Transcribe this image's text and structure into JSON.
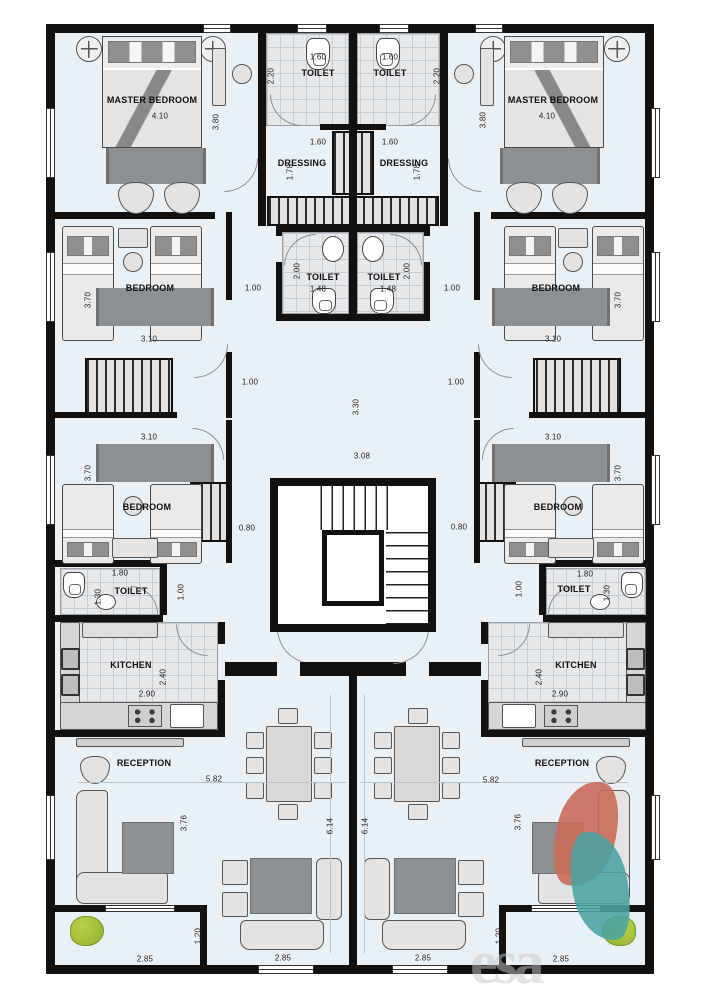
{
  "colors": {
    "floor": "#e9f1f7",
    "wall": "#111111",
    "tile": "#e6e8ea",
    "rug": "#8d9092",
    "furniture": "#e3e3e3",
    "logo_red": "#c96c59",
    "logo_teal": "#4aa3a2",
    "plant": "#9fbe3a"
  },
  "watermark": {
    "text": "esa"
  },
  "labels": [
    {
      "n": "label-master-bedroom",
      "t": "MASTER BEDROOM",
      "x": 152,
      "y": 100,
      "r": 1
    },
    {
      "n": "label-master-bedroom",
      "t": "MASTER BEDROOM",
      "x": 553,
      "y": 100,
      "r": 1
    },
    {
      "n": "label-toilet",
      "t": "TOILET",
      "x": 318,
      "y": 73,
      "r": 1
    },
    {
      "n": "label-toilet",
      "t": "TOILET",
      "x": 390,
      "y": 73,
      "r": 1
    },
    {
      "n": "label-dressing",
      "t": "DRESSING",
      "x": 302,
      "y": 163,
      "r": 1
    },
    {
      "n": "label-dressing",
      "t": "DRESSING",
      "x": 404,
      "y": 163,
      "r": 1
    },
    {
      "n": "label-toilet",
      "t": "TOILET",
      "x": 323,
      "y": 277,
      "r": 1
    },
    {
      "n": "label-toilet",
      "t": "TOILET",
      "x": 384,
      "y": 277,
      "r": 1
    },
    {
      "n": "label-bedroom",
      "t": "BEDROOM",
      "x": 150,
      "y": 288,
      "r": 1
    },
    {
      "n": "label-bedroom",
      "t": "BEDROOM",
      "x": 556,
      "y": 288,
      "r": 1
    },
    {
      "n": "label-bedroom",
      "t": "BEDROOM",
      "x": 147,
      "y": 507,
      "r": 1
    },
    {
      "n": "label-bedroom",
      "t": "BEDROOM",
      "x": 558,
      "y": 507,
      "r": 1
    },
    {
      "n": "label-toilet",
      "t": "TOILET",
      "x": 131,
      "y": 591,
      "r": 1
    },
    {
      "n": "label-toilet",
      "t": "TOILET",
      "x": 574,
      "y": 589,
      "r": 1
    },
    {
      "n": "label-kitchen",
      "t": "KITCHEN",
      "x": 131,
      "y": 665,
      "r": 1
    },
    {
      "n": "label-kitchen",
      "t": "KITCHEN",
      "x": 576,
      "y": 665,
      "r": 1
    },
    {
      "n": "label-reception",
      "t": "RECEPTION",
      "x": 144,
      "y": 763,
      "r": 1
    },
    {
      "n": "label-reception",
      "t": "RECEPTION",
      "x": 562,
      "y": 763,
      "r": 1
    },
    {
      "n": "label-dimension",
      "t": "4.10",
      "x": 160,
      "y": 116
    },
    {
      "n": "label-dimension",
      "t": "4.10",
      "x": 547,
      "y": 116
    },
    {
      "n": "label-dimension",
      "t": "3.80",
      "x": 216,
      "y": 122,
      "v": 1
    },
    {
      "n": "label-dimension",
      "t": "3.80",
      "x": 483,
      "y": 120,
      "v": 1
    },
    {
      "n": "label-dimension",
      "t": "1.60",
      "x": 318,
      "y": 57
    },
    {
      "n": "label-dimension",
      "t": "1.60",
      "x": 390,
      "y": 57
    },
    {
      "n": "label-dimension",
      "t": "2.20",
      "x": 271,
      "y": 76,
      "v": 1
    },
    {
      "n": "label-dimension",
      "t": "2.20",
      "x": 437,
      "y": 76,
      "v": 1
    },
    {
      "n": "label-dimension",
      "t": "1.60",
      "x": 318,
      "y": 142
    },
    {
      "n": "label-dimension",
      "t": "1.60",
      "x": 390,
      "y": 142
    },
    {
      "n": "label-dimension",
      "t": "1.78",
      "x": 290,
      "y": 172,
      "v": 1
    },
    {
      "n": "label-dimension",
      "t": "1.78",
      "x": 417,
      "y": 172,
      "v": 1
    },
    {
      "n": "label-dimension",
      "t": "1.48",
      "x": 318,
      "y": 289
    },
    {
      "n": "label-dimension",
      "t": "1.48",
      "x": 388,
      "y": 289
    },
    {
      "n": "label-dimension",
      "t": "2.00",
      "x": 297,
      "y": 271,
      "v": 1
    },
    {
      "n": "label-dimension",
      "t": "2.00",
      "x": 407,
      "y": 271,
      "v": 1
    },
    {
      "n": "label-dimension",
      "t": "1.00",
      "x": 253,
      "y": 288
    },
    {
      "n": "label-dimension",
      "t": "1.00",
      "x": 452,
      "y": 288
    },
    {
      "n": "label-dimension",
      "t": "3.70",
      "x": 88,
      "y": 300,
      "v": 1
    },
    {
      "n": "label-dimension",
      "t": "3.70",
      "x": 618,
      "y": 300,
      "v": 1
    },
    {
      "n": "label-dimension",
      "t": "3.10",
      "x": 149,
      "y": 339
    },
    {
      "n": "label-dimension",
      "t": "3.10",
      "x": 553,
      "y": 339
    },
    {
      "n": "label-dimension",
      "t": "1.00",
      "x": 250,
      "y": 382
    },
    {
      "n": "label-dimension",
      "t": "1.00",
      "x": 456,
      "y": 382
    },
    {
      "n": "label-dimension",
      "t": "3.30",
      "x": 356,
      "y": 407,
      "v": 1
    },
    {
      "n": "label-dimension",
      "t": "3.08",
      "x": 362,
      "y": 456
    },
    {
      "n": "label-dimension",
      "t": "3.10",
      "x": 149,
      "y": 437
    },
    {
      "n": "label-dimension",
      "t": "3.10",
      "x": 553,
      "y": 437
    },
    {
      "n": "label-dimension",
      "t": "3.70",
      "x": 88,
      "y": 473,
      "v": 1
    },
    {
      "n": "label-dimension",
      "t": "3.70",
      "x": 618,
      "y": 473,
      "v": 1
    },
    {
      "n": "label-dimension",
      "t": "0.80",
      "x": 247,
      "y": 528
    },
    {
      "n": "label-dimension",
      "t": "0.80",
      "x": 459,
      "y": 527
    },
    {
      "n": "label-dimension",
      "t": "1.80",
      "x": 120,
      "y": 573
    },
    {
      "n": "label-dimension",
      "t": "1.80",
      "x": 585,
      "y": 574
    },
    {
      "n": "label-dimension",
      "t": "1.30",
      "x": 98,
      "y": 597,
      "v": 1
    },
    {
      "n": "label-dimension",
      "t": "1.30",
      "x": 607,
      "y": 593,
      "v": 1
    },
    {
      "n": "label-dimension",
      "t": "1.00",
      "x": 181,
      "y": 592,
      "v": 1
    },
    {
      "n": "label-dimension",
      "t": "1.00",
      "x": 519,
      "y": 589,
      "v": 1
    },
    {
      "n": "label-dimension",
      "t": "2.40",
      "x": 163,
      "y": 677,
      "v": 1
    },
    {
      "n": "label-dimension",
      "t": "2.40",
      "x": 539,
      "y": 677,
      "v": 1
    },
    {
      "n": "label-dimension",
      "t": "2.90",
      "x": 147,
      "y": 694
    },
    {
      "n": "label-dimension",
      "t": "2.90",
      "x": 560,
      "y": 694
    },
    {
      "n": "label-dimension",
      "t": "5.82",
      "x": 214,
      "y": 779
    },
    {
      "n": "label-dimension",
      "t": "5.82",
      "x": 491,
      "y": 780
    },
    {
      "n": "label-dimension",
      "t": "3.76",
      "x": 184,
      "y": 823,
      "v": 1
    },
    {
      "n": "label-dimension",
      "t": "3.76",
      "x": 518,
      "y": 822,
      "v": 1
    },
    {
      "n": "label-dimension",
      "t": "6.14",
      "x": 330,
      "y": 826,
      "v": 1
    },
    {
      "n": "label-dimension",
      "t": "6.14",
      "x": 365,
      "y": 826,
      "v": 1
    },
    {
      "n": "label-dimension",
      "t": "1.20",
      "x": 198,
      "y": 936,
      "v": 1
    },
    {
      "n": "label-dimension",
      "t": "1.20",
      "x": 499,
      "y": 936,
      "v": 1
    },
    {
      "n": "label-dimension",
      "t": "2.85",
      "x": 145,
      "y": 959
    },
    {
      "n": "label-dimension",
      "t": "2.85",
      "x": 283,
      "y": 958
    },
    {
      "n": "label-dimension",
      "t": "2.85",
      "x": 423,
      "y": 958
    },
    {
      "n": "label-dimension",
      "t": "2.85",
      "x": 561,
      "y": 959
    }
  ]
}
